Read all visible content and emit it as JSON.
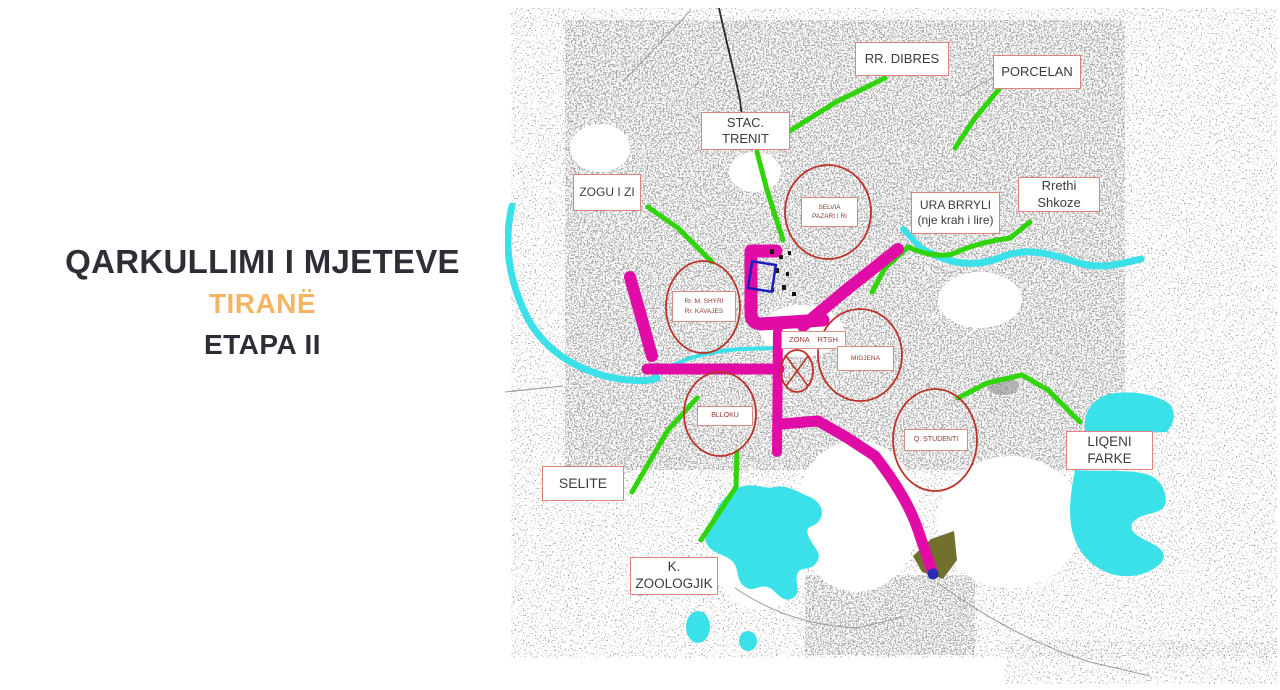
{
  "slide": {
    "title": {
      "line1": "QARKULLIMI I MJETEVE",
      "line2": "TIRANË",
      "line3": "ETAPA II"
    }
  },
  "map": {
    "labels": {
      "rr_dibres": "RR. DIBRES",
      "porcelan": "PORCELAN",
      "stac_trenit": "STAC. TRENIT",
      "zogu_i_zi": "ZOGU I ZI",
      "ura_brryli_line1": "URA BRRYLI",
      "ura_brryli_line2": "(nje krah i lire)",
      "rrethi_shkoze": "Rrethi Shkoze",
      "selite": "SELITE",
      "k_zoologjik": "K. ZOOLOGJIK",
      "liqeni_farke": "LIQENI FARKE"
    },
    "zones": {
      "selvia_line1": "SELVIA",
      "selvia_line2": "PAZARI I RI",
      "mshyri_line1": "Rr. M. SHYRI",
      "mshyri_line2": "Rr. KAVAJES",
      "blloku": "BLLOKU",
      "zona_rtsh": "ZONA RTSH",
      "migjena": "MIGJENA",
      "q_studenti": "Q. STUDENTI"
    },
    "colors": {
      "route_primary_magenta": "#E10CA5",
      "route_secondary_green": "#2FD409",
      "water_cyan": "#3AE1E8",
      "zone_circle_red": "#BD3228",
      "label_border_red": "#E2827D",
      "title_accent_orange": "#F3B563",
      "title_dark": "#2D2E36"
    }
  }
}
